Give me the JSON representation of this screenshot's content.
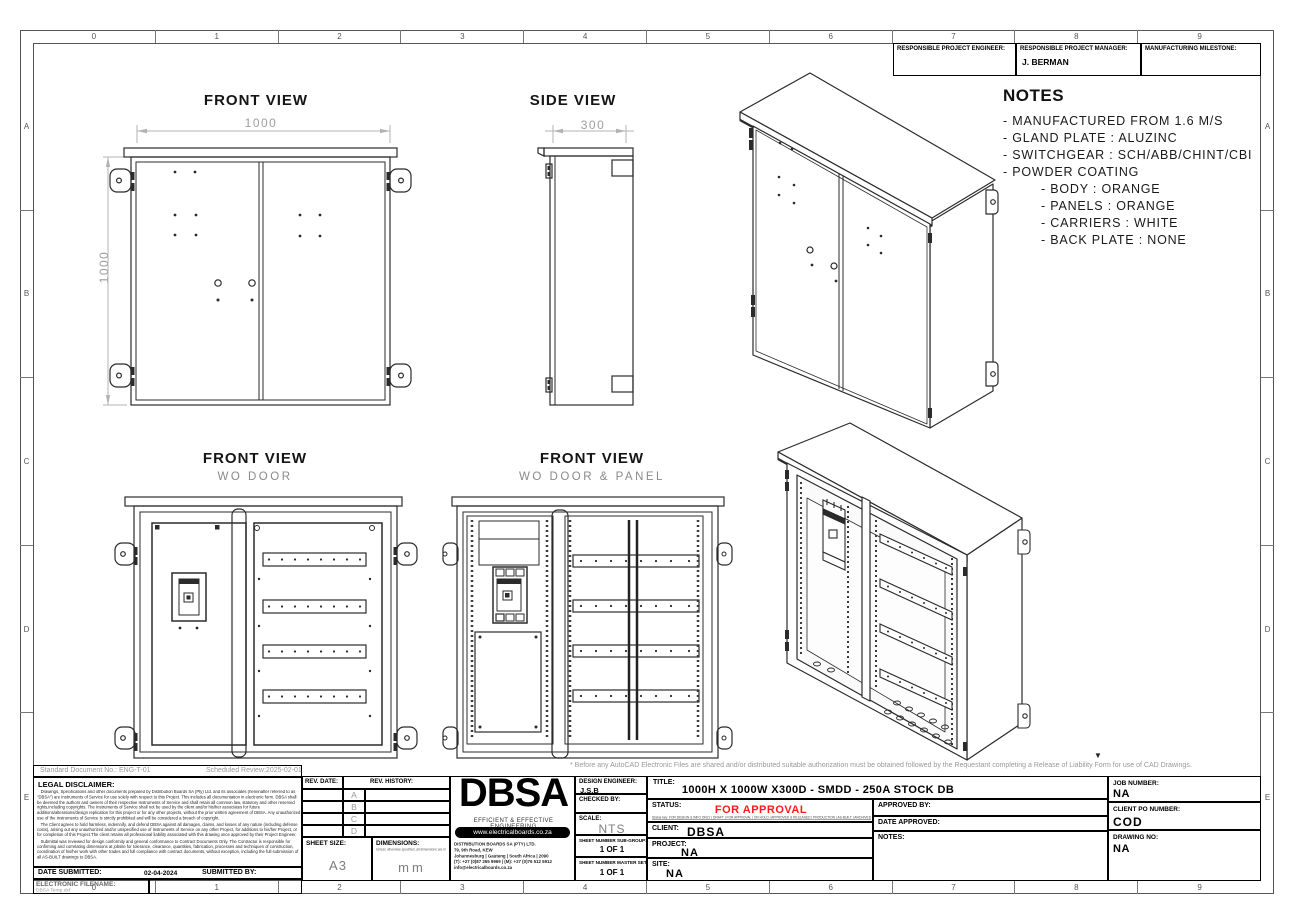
{
  "sheet": {
    "grid_columns": [
      "0",
      "1",
      "2",
      "3",
      "4",
      "5",
      "6",
      "7",
      "8",
      "9"
    ],
    "grid_rows": [
      "A",
      "B",
      "C",
      "D",
      "E"
    ]
  },
  "header_strip": {
    "engineer_label": "RESPONSIBLE PROJECT ENGINEER:",
    "engineer_value": "",
    "manager_label": "RESPONSIBLE PROJECT MANAGER:",
    "manager_value": "J. BERMAN",
    "milestone_label": "MANUFACTURING MILESTONE:",
    "milestone_value": ""
  },
  "notes": {
    "title": "NOTES",
    "lines": [
      "- MANUFACTURED FROM 1.6 M/S",
      "- GLAND PLATE : ALUZINC",
      "- SWITCHGEAR : SCH/ABB/CHINT/CBI",
      "- POWDER COATING"
    ],
    "sub_lines": [
      "- BODY : ORANGE",
      "- PANELS : ORANGE",
      "- CARRIERS : WHITE",
      "- BACK PLATE : NONE"
    ]
  },
  "views": {
    "front": {
      "title": "FRONT VIEW",
      "dim_width": "1000",
      "dim_height": "1000"
    },
    "side": {
      "title": "SIDE VIEW",
      "dim_width": "300"
    },
    "wo_door": {
      "title": "FRONT VIEW",
      "subtitle": "WO DOOR"
    },
    "wo_door_panel": {
      "title": "FRONT VIEW",
      "subtitle": "WO DOOR & PANEL"
    }
  },
  "cad_note": "*  Before any AutoCAD Electronic Files are shared and/or distributed suitable authorization must be obtained followed by the Requestant completing a Release of Liability Form for use of CAD Drawings.",
  "doc_strip": {
    "standard_doc": "Standard Document No.: ENG-T-01",
    "scheduled_review": "Scheduled Review:2025-02-01"
  },
  "legal": {
    "title": "LEGAL DISCLAIMER:",
    "p1": "Drawings, Specifications and other documents prepared by Distribution Boards SA (Pty) Ltd. and its associates (hereinafter referred to as \"DBSA\") are Instruments of Service for use solely with respect to this Project. This includes all documentation in electronic form. DBSA shall be deemed the authors and owners of their respective Instruments of Service and shall retain all common law, statutory and other reserved rights,including copyrights. The Instruments of Service shall not be used by the client and/or his/her associates for future additions/alterations/design replication for this project or for any other projects, without the prior written agreement of DBSA. Any unauthorized use of the Instruments of Service is strictly prohibited and will be considered a breach of copyright.",
    "p2": "The Client agrees to hold harmless, indemnify, and defend DBSA against all damages, claims, and losses of any nature (including defense costs), arising out any unauthorized and/or unspecified use of Instruments of Service on any other Project, for additions to his/her Project, or for completion of this Project.The client retains all professional liability associated with this drawing once approved by their Project Engineer.",
    "p3": "Submittal was reviewed for design conformity and general conformance to Contract Documents Only. The Contractor is responsible for confirming and correlating dimensions at jobsite for tolerance, clearance, quantities, fabrication, processes and techniques of construction, coordination of his/her work with other trades and full compliance with contract documents, without exception, including the full submission of all AS-BUILT drawings to DBSA."
  },
  "rev_table": {
    "date_label": "REV. DATE:",
    "history_label": "REV. HISTORY:",
    "rows": [
      "A",
      "B",
      "C",
      "D"
    ]
  },
  "sheet_info": {
    "sheet_size_label": "SHEET SIZE:",
    "sheet_size": "A3",
    "dimensions_label": "DIMENSIONS:",
    "dimensions_note": "Unless otherwise specified, all dimensions are in",
    "dimensions_unit": "mm"
  },
  "brand": {
    "name": "DBSA",
    "tagline": "EFFICIENT & EFFECTIVE ENGINEERING",
    "website": "www.electricalboards.co.za",
    "company": "DISTRIBUTION BOARDS SA (PTY) LTD.",
    "address1": "79, 9th Road, KEW",
    "address2": "Johannesburg | Gauteng | South Africa | 2090",
    "phone": "(T): +27 (0)87 265 9969 | (M): +27 (0)76 512 5912",
    "email": "info@electricalboards.co.za"
  },
  "titleblock": {
    "design_engineer_label": "DESIGN ENGINEER:",
    "design_engineer": "J.S.B",
    "checked_by_label": "CHECKED BY:",
    "checked_by": "",
    "scale_label": "SCALE:",
    "scale": "NTS",
    "sheet_sub_label": "SHEET NUMBER SUB-GROUP:",
    "sheet_sub": "1 OF 1",
    "sheet_master_label": "SHEET NUMBER MASTER SET:",
    "sheet_master": "1 OF 1",
    "title_label": "TITLE:",
    "title": "1000H X 1000W X300D - SMDD - 250A STOCK DB",
    "status_label": "STATUS:",
    "status": "FOR APPROVAL",
    "status_color": "#ff1a1a",
    "status_options": "Status key: FOR DESIGN & INFO ONLY | DRAFT | FOR APPROVAL | ON HOLD | APPROVED & RELEASED | PRODUCTION | AS-BUILT | ARCHIVED",
    "client_label": "CLIENT:",
    "client": "DBSA",
    "project_label": "PROJECT:",
    "project": "NA",
    "site_label": "SITE:",
    "site": "NA",
    "approved_by_label": "APPROVED BY:",
    "approved_by": "",
    "date_approved_label": "DATE APPROVED:",
    "date_approved": "",
    "notes_label": "NOTES:",
    "notes": "",
    "job_number_label": "JOB NUMBER:",
    "job_number": "NA",
    "client_po_label": "CLIENT PO NUMBER:",
    "client_po": "COD",
    "drawing_no_label": "DRAWING NO:",
    "drawing_no": "NA",
    "date_submitted_label": "DATE SUBMITTED:",
    "date_submitted": "02-04-2024",
    "submitted_by_label": "SUBMITTED BY:",
    "filename_label": "ELECTRONIC FILENAME:",
    "filename": "DBSA Temp.dxf"
  }
}
